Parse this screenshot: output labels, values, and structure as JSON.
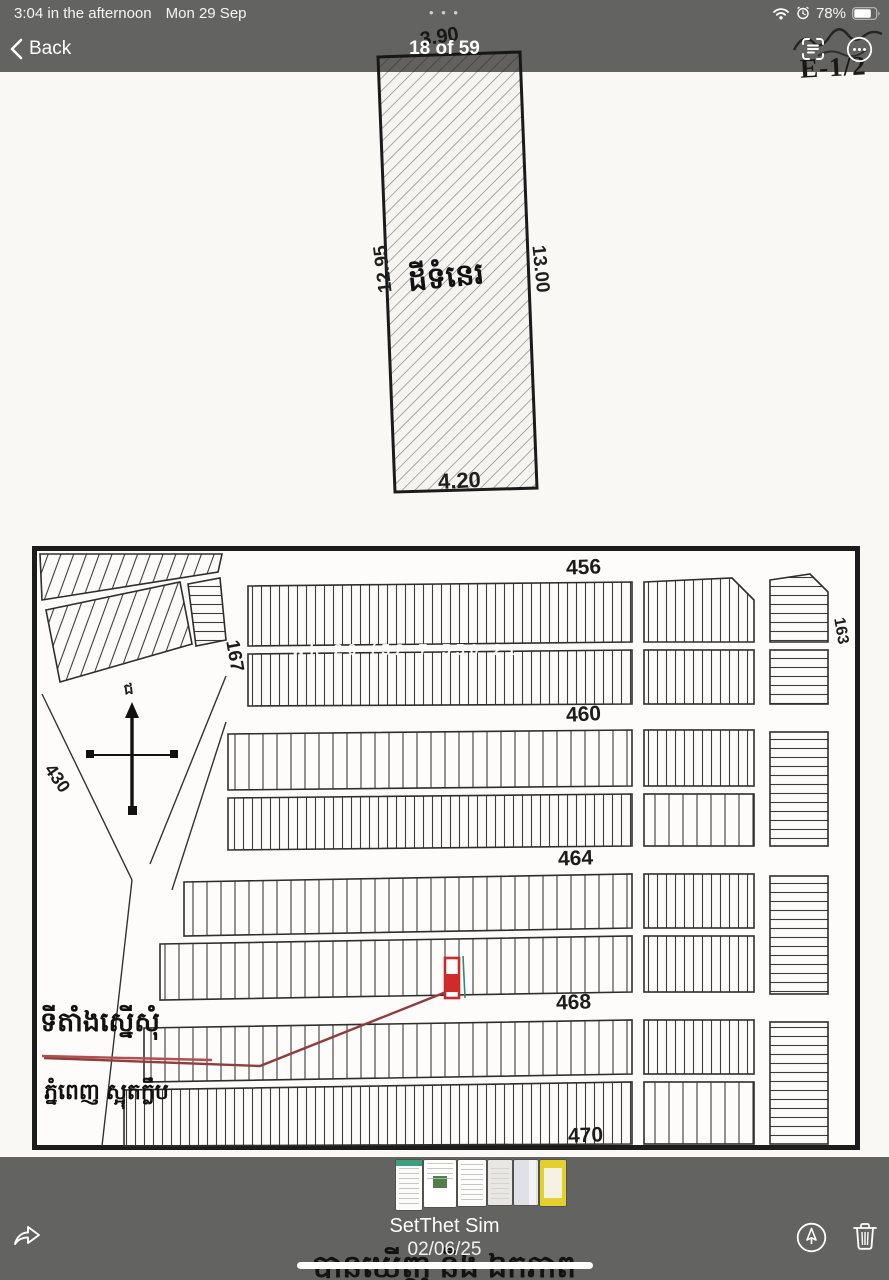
{
  "status_bar": {
    "time": "3:04 in the afternoon",
    "date": "Mon 29 Sep",
    "battery_percent": "78%",
    "multitask_dots": "• • •"
  },
  "nav_bar": {
    "back_label": "Back",
    "title": "18 of 59"
  },
  "doc": {
    "plot": {
      "width_top": "3.90",
      "side_left": "12.95",
      "side_right": "13.00",
      "width_bottom": "4.20",
      "label": "ដីទំនេរ"
    },
    "corner_ref": "E-1/2",
    "watermark": "wh 20 (52 7 550 21",
    "map": {
      "streets": {
        "s1": "456",
        "s2": "460",
        "s3": "464",
        "s4": "468",
        "s5": "470",
        "left": "167",
        "right": "163",
        "diag": "430"
      },
      "compass_n": "ជ",
      "location_label": "ទីតាំងស្នើសុំ",
      "sub_label": "ភ្នំពេញ ស្អុតក្លឹប"
    },
    "bottom_text": "បានឃើញ និង ឯកភាព"
  },
  "footer": {
    "name": "SetThet Sim",
    "date": "02/06/25"
  },
  "colors": {
    "bar_overlay": "rgba(22,22,22,0.66)",
    "marker_red": "#cc2a2a",
    "route_red": "#8f3d3d",
    "thumb_green": "#3f9e7c",
    "thumb_yellow": "#e3cf2e"
  }
}
